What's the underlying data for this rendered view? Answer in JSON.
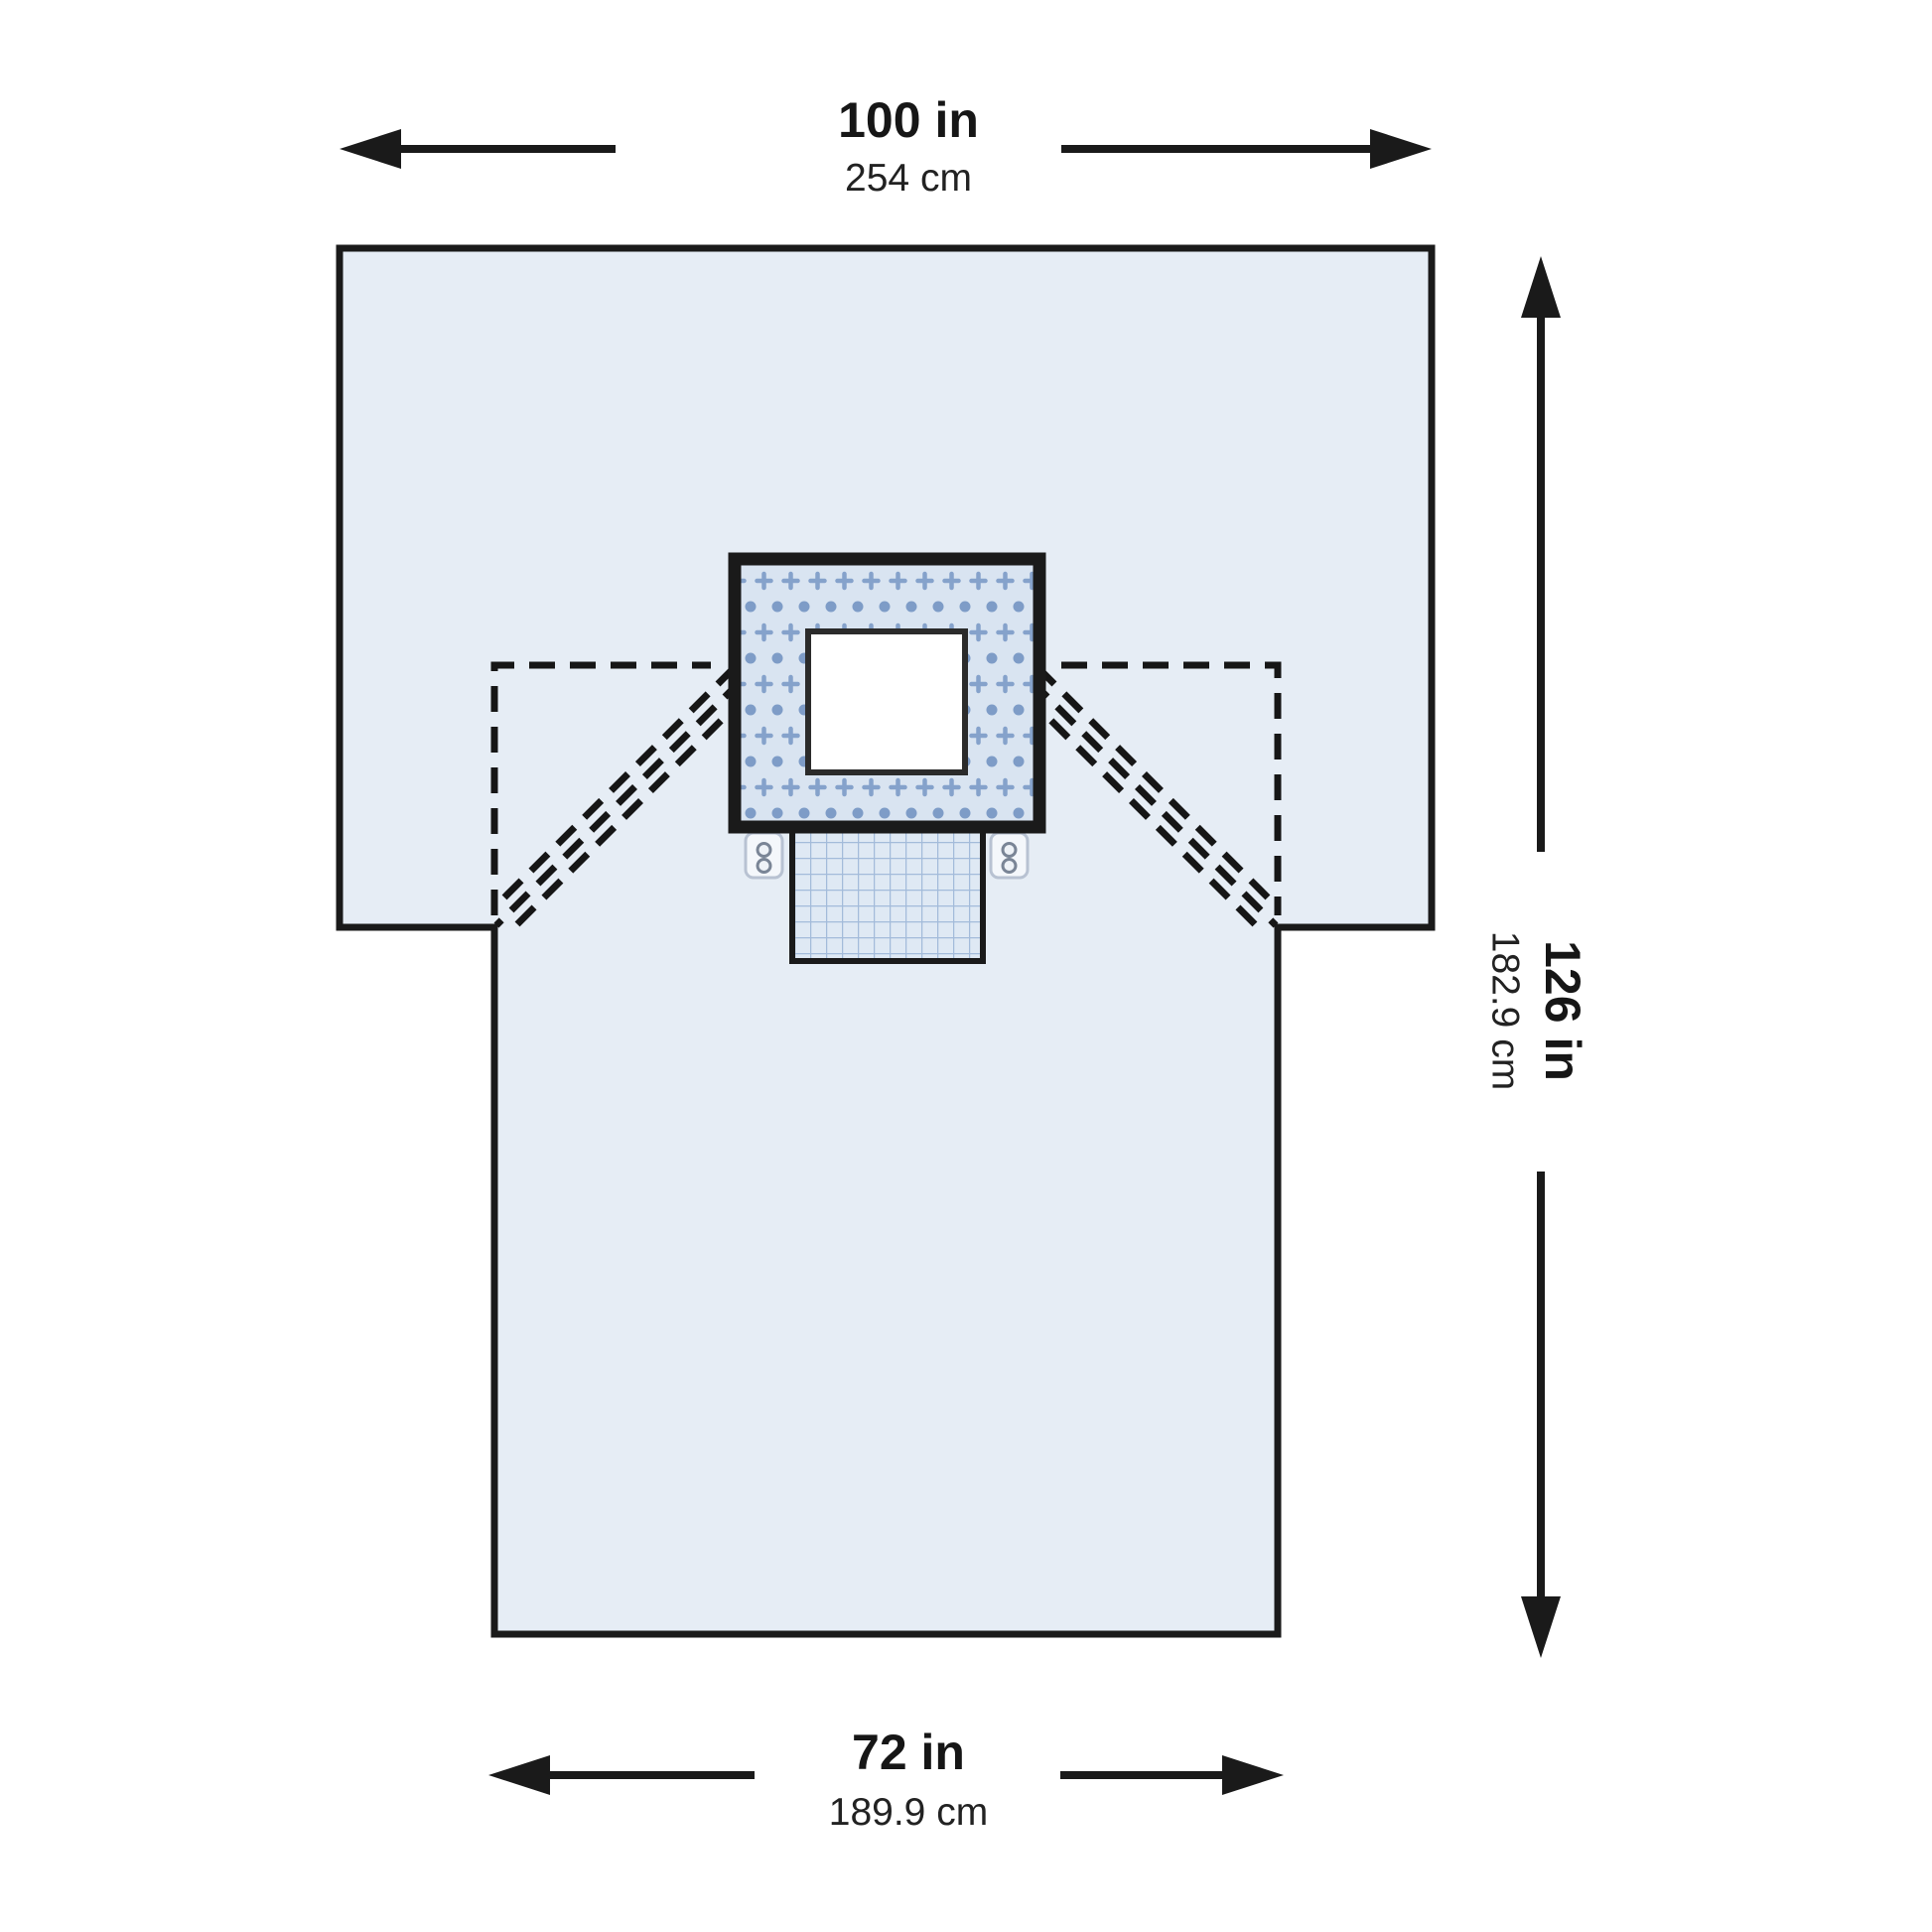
{
  "figure": {
    "description": "T-shaped surgical drape diagram with reinforced fenestration patch, gridded pouch, tube-holder tabs, dashed fold lines and dimension arrows"
  },
  "labels": {
    "top_width_in": "100 in",
    "top_width_cm": "254 cm",
    "side_length_in": "126 in",
    "side_length_cm": "182.9 cm",
    "bottom_width_in": "72 in",
    "bottom_width_cm": "189.9 cm"
  },
  "colors": {
    "background": "#ffffff",
    "outline": "#1a1a1a",
    "dashed_line": "#161616",
    "drape_fill": "#e6edf5",
    "patch_fill": "#d9e4f1",
    "patch_cross": "#85a2cb",
    "patch_dot": "#7e9cc7",
    "fenestration_fill": "#ffffff",
    "fenestration_border": "#2b2b2b",
    "pouch_fill": "#dfe9f4",
    "pouch_grid": "#a3bbda",
    "tab_fill": "#f4f7fb",
    "tab_border": "#b8c2d2",
    "tab_hole_ring": "#7a8596",
    "tab_hole_fill": "#eef2f7",
    "text_color": "#161616"
  }
}
